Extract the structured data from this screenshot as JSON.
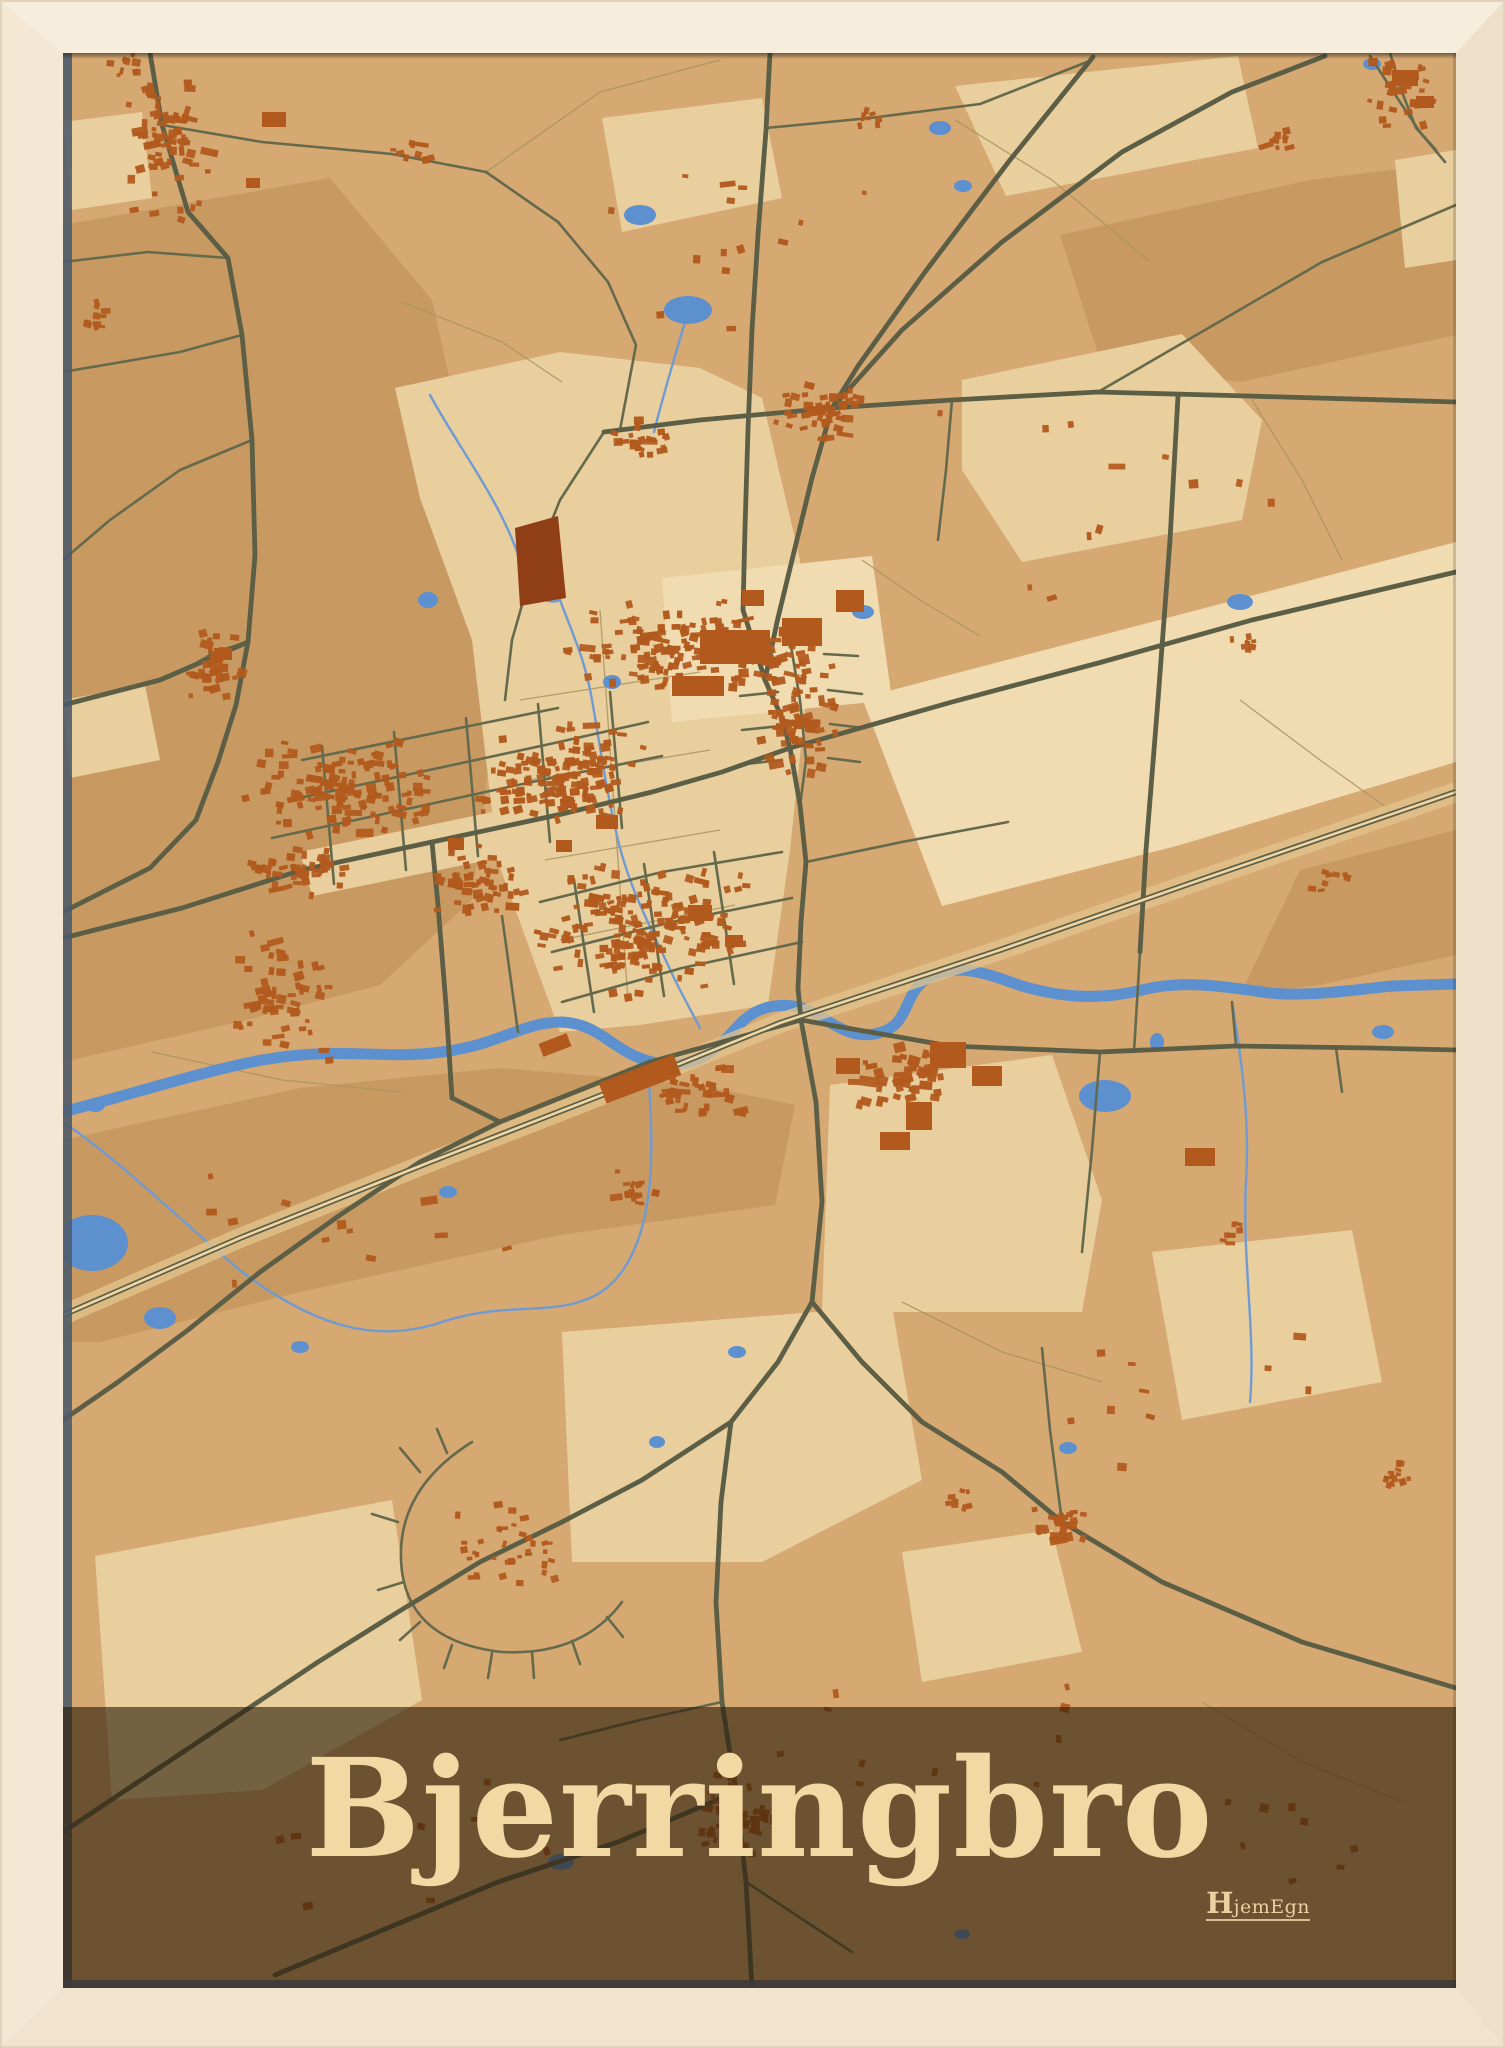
{
  "poster": {
    "title": "Bjerringbro"
  },
  "logo": {
    "h": "H",
    "rest": "jemEgn"
  },
  "colors": {
    "frame": "#f4e8d5",
    "map_base": "#d6a872",
    "patch_light": "#e9cf9e",
    "patch_xlight": "#f1dcb2",
    "patch_dark": "#c89a62",
    "road_main": "#5c5f45",
    "road_minor": "#666a4d",
    "path_thin": "#a8945f",
    "railway_band": "#e3c48e",
    "railway_line": "#5c5f45",
    "railway_center": "#efd6a6",
    "water": "#5d90cf",
    "stream": "#6f9bd2",
    "building": "#b25a1e",
    "building_dark": "#8f3e16",
    "banner_overlay": "rgba(43,29,9,0.62)",
    "title_color": "#f2d8a2",
    "logo_color": "#e9d2a2",
    "shadow_slate": "#4c5a6b"
  },
  "map": {
    "viewBox": "63 53 1393 1935",
    "patches": [
      {
        "c": "dark",
        "d": "M63,225 L330,178 L432,300 L470,470 L498,690 L472,900 L380,985 L238,1022 L63,1062 Z"
      },
      {
        "c": "dark",
        "d": "M1060,235 L1310,180 L1456,162 L1456,335 L1240,382 L1100,360 Z"
      },
      {
        "c": "dark",
        "d": "M63,1140 L300,1088 L500,1068 L700,1085 L795,1105 L775,1205 L560,1235 L300,1292 L100,1342 L63,1342 Z"
      },
      {
        "c": "dark",
        "d": "M1300,870 L1456,830 L1456,955 L1320,985 L1240,995 Z"
      },
      {
        "c": "light",
        "d": "M395,388 L560,352 L700,368 L762,398 L800,560 L806,700 L790,850 L768,1005 L640,1025 L560,1032 L498,862 L472,640 L420,498 Z"
      },
      {
        "c": "light",
        "d": "M955,86 L1238,56 L1258,148 L1006,196 Z"
      },
      {
        "c": "light",
        "d": "M962,380 L1182,334 L1262,420 L1242,520 L1022,562 L962,470 Z"
      },
      {
        "c": "xlight",
        "d": "M862,698 L1456,542 L1456,762 L1180,845 L942,906 Z"
      },
      {
        "c": "light",
        "d": "M830,1085 L1052,1055 L1102,1200 L1082,1312 L822,1312 Z"
      },
      {
        "c": "light",
        "d": "M95,1556 L392,1500 L422,1700 L262,1790 L112,1800 Z"
      },
      {
        "c": "light",
        "d": "M562,1332 L892,1306 L922,1480 L762,1562 L572,1562 Z"
      },
      {
        "c": "light",
        "d": "M602,118 L762,98 L782,198 L622,232 Z"
      },
      {
        "c": "xlight",
        "d": "M662,578 L872,556 L892,700 L672,722 Z"
      },
      {
        "c": "light",
        "d": "M300,852 L560,798 L722,752 L762,790 L562,845 L312,896 Z"
      },
      {
        "c": "light",
        "d": "M1152,1252 L1352,1230 L1382,1382 L1182,1420 Z"
      },
      {
        "c": "light",
        "d": "M63,122 L142,112 L152,198 L72,210 Z"
      },
      {
        "c": "light",
        "d": "M1395,160 L1456,150 L1456,260 L1405,268 Z"
      },
      {
        "c": "light",
        "d": "M902,1552 L1052,1530 L1082,1652 L922,1682 Z"
      },
      {
        "c": "light",
        "d": "M63,700 L145,685 L160,760 L70,778 Z"
      }
    ],
    "paths_thin": [
      "M486,172 L600,92 L720,60",
      "M955,120 L1052,180 L1150,262",
      "M1252,400 L1302,480 L1342,560",
      "M520,700 L700,672",
      "M530,780 L710,750",
      "M545,860 L720,830",
      "M560,940 L735,905",
      "M600,610 L628,1000",
      "M152,1052 L282,1080 L402,1092",
      "M902,1302 L1002,1352 L1102,1382",
      "M1202,1702 L1302,1762 L1402,1802",
      "M402,302 L502,342 L562,382",
      "M862,560 L920,600 L980,636",
      "M1240,700 L1320,760 L1390,810"
    ],
    "streams": [
      "M560,600 C575,640 585,660 592,700 C600,745 606,790 618,840 C630,890 652,930 668,965 C680,992 692,1012 700,1028",
      "M63,1122 C122,1162 182,1222 242,1272 C322,1332 382,1342 442,1322 C502,1302 545,1315 585,1300 C625,1286 645,1240 650,1180 C653,1140 650,1100 648,1064",
      "M1232,1002 C1242,1062 1250,1122 1246,1182 C1242,1262 1256,1332 1250,1402",
      "M688,312 C676,352 664,392 654,432",
      "M430,395 C460,450 500,500 520,560 C535,600 548,605 560,600"
    ],
    "river": "M63,1112 C140,1092 200,1072 262,1060 C342,1046 382,1060 442,1052 C502,1044 522,1022 562,1022 C602,1024 612,1052 652,1062 C702,1074 722,1042 742,1022 C762,1002 792,1002 812,1012 C832,1022 852,1042 882,1032 C912,1022 902,990 932,976 C962,962 992,976 1022,986 C1062,998 1102,1000 1142,990 C1182,980 1222,986 1262,992 C1302,998 1352,990 1392,986 L1456,984",
    "railway": "M63,1315 L240,1238 L430,1162 L620,1088 L780,1023 L1000,950 L1200,880 L1456,792",
    "lakes": [
      [
        92,
        1243,
        36,
        28
      ],
      [
        160,
        1318,
        16,
        11
      ],
      [
        640,
        215,
        16,
        10
      ],
      [
        688,
        310,
        24,
        14
      ],
      [
        940,
        128,
        11,
        7
      ],
      [
        963,
        186,
        9,
        6
      ],
      [
        428,
        600,
        10,
        8
      ],
      [
        612,
        682,
        9,
        7
      ],
      [
        863,
        612,
        11,
        7
      ],
      [
        1240,
        602,
        13,
        8
      ],
      [
        1105,
        1096,
        26,
        16
      ],
      [
        1383,
        1032,
        11,
        7
      ],
      [
        300,
        1347,
        9,
        6
      ],
      [
        448,
        1192,
        9,
        6
      ],
      [
        657,
        1442,
        8,
        6
      ],
      [
        1068,
        1448,
        9,
        6
      ],
      [
        561,
        1862,
        13,
        8
      ],
      [
        962,
        1934,
        8,
        5
      ],
      [
        737,
        1352,
        9,
        6
      ],
      [
        95,
        1105,
        10,
        7
      ],
      [
        1372,
        64,
        9,
        6
      ],
      [
        1157,
        1042,
        7,
        9
      ]
    ],
    "roads_minor": [
      "M162,125 L262,142 L392,154 L486,172",
      "M1456,205 L1322,262 L1205,330 L1098,392",
      "M604,432 L560,500 L532,570 L512,640 L505,700",
      "M486,172 L558,222 L608,282 L636,345 L620,430",
      "M790,640 L800,700 L806,760 L800,806",
      "M776,658 L742,660",
      "M778,692 L740,696",
      "M780,726 L742,730",
      "M782,760 L746,764",
      "M824,654 L858,656",
      "M828,690 L862,694",
      "M830,724 L864,728",
      "M828,758 L860,762",
      "M290,800 L420,772 L550,744 L648,722",
      "M272,838 L402,810 L532,782 L662,756",
      "M302,760 L430,734 L558,708",
      "M322,746 L334,884",
      "M394,732 L406,870",
      "M466,718 L478,856",
      "M538,704 L550,842",
      "M610,692 L622,828",
      "M540,902 L662,872 L782,852",
      "M552,952 L672,922 L792,898",
      "M562,1002 L682,968 L802,942",
      "M574,880 L594,1012",
      "M644,864 L664,996",
      "M714,852 L734,984",
      "M502,916 L518,1032",
      "M806,862 L902,842 L1008,822",
      "M1236,1046 L1232,1002",
      "M1336,1048 L1342,1092",
      "M1100,1052 L1092,1150 L1082,1252",
      "M472,1442 Q392,1492 402,1572 Q412,1642 502,1652 Q582,1656 622,1602",
      "M420,1472 L400,1448",
      "M398,1522 L372,1514",
      "M404,1582 L378,1590",
      "M420,1622 L400,1640",
      "M452,1645 L444,1668",
      "M492,1653 L488,1678",
      "M532,1652 L534,1678",
      "M572,1641 L580,1664",
      "M607,1617 L623,1637",
      "M447,1453 L437,1429",
      "M63,262 L148,252 L228,258",
      "M242,335 L180,352 L63,372",
      "M252,440 L180,470 L110,520 L63,560",
      "M1140,952 L1134,1052",
      "M1062,1522 L1050,1430 L1042,1348",
      "M746,1882 L852,1952",
      "M1370,56 L1396,96 L1420,132 L1445,162",
      "M766,128 L870,118 L980,104 L1092,60",
      "M952,400 L946,470 L938,540",
      "M248,642 L215,652 L188,668",
      "M1390,53 L1402,92 L1416,128 L1436,150",
      "M722,1702 L640,1720 L560,1740"
    ],
    "roads_main": [
      "M150,53 L162,125 L188,212 L228,258 L242,335 L252,440 L255,555 L248,642",
      "M248,642 L236,705 L218,762 L196,820 L150,868 L63,912",
      "M248,642 L160,680 L63,705",
      "M770,53 L766,130 L758,235 L752,330 L748,430 L745,528 L743,610 L765,680 L782,718 L790,748",
      "M1093,57 L1010,160 L925,272 L858,366 L832,408",
      "M832,408 L812,478 L793,556 L777,622 L765,680",
      "M604,432 L700,420 L832,408 L952,400 L1098,392 L1248,396 L1456,402",
      "M832,408 L902,330 L1002,242 L1122,152 L1232,92 L1325,56",
      "M63,938 L182,908 L302,870 L432,842 L562,814 L652,792 L722,772 L790,748",
      "M790,748 L952,702 L1102,662 L1252,620 L1456,572",
      "M790,748 L800,805 L806,862 L801,922 L798,988 L801,1020",
      "M801,1020 L816,1102 L822,1202 L812,1302",
      "M801,1020 L950,1046 L1100,1052 L1236,1046 L1372,1048 L1456,1050",
      "M500,1122 L650,1062 L801,1020",
      "M812,1302 L778,1362 L731,1422 L642,1480 L562,1522",
      "M812,1302 L862,1362 L922,1422 L1002,1472 L1062,1522 L1162,1582 L1302,1642 L1456,1688",
      "M731,1422 L721,1502 L716,1602 L722,1702 L736,1792 L746,1882 L752,1988",
      "M562,1522 L480,1562 L398,1612 L318,1662 L228,1722 L138,1782 L63,1832",
      "M736,1792 L618,1842 L498,1882 L378,1932 L275,1975",
      "M432,842 L438,905 L446,1005 L452,1098 L500,1122",
      "M500,1122 L420,1162 L340,1215 L260,1272 L188,1330 L118,1382 L63,1420",
      "M1178,396 L1170,540 L1158,700 L1146,850 L1140,952"
    ],
    "wedge": "M515,528 L558,516 L566,598 L520,606 Z",
    "big_buildings": [
      [
        700,
        630,
        70,
        34,
        0
      ],
      [
        782,
        618,
        40,
        28,
        0
      ],
      [
        672,
        676,
        52,
        20,
        0
      ],
      [
        836,
        590,
        28,
        22,
        0
      ],
      [
        742,
        590,
        22,
        16,
        0
      ],
      [
        600,
        1068,
        80,
        22,
        -21
      ],
      [
        540,
        1038,
        30,
        14,
        -21
      ],
      [
        930,
        1042,
        36,
        26,
        0
      ],
      [
        972,
        1066,
        30,
        20,
        0
      ],
      [
        906,
        1102,
        26,
        28,
        0
      ],
      [
        880,
        1132,
        30,
        18,
        0
      ],
      [
        836,
        1058,
        24,
        16,
        0
      ],
      [
        1185,
        1148,
        30,
        18,
        0
      ],
      [
        262,
        112,
        24,
        15,
        0
      ],
      [
        246,
        178,
        14,
        10,
        0
      ],
      [
        1392,
        70,
        26,
        16,
        0
      ],
      [
        1416,
        96,
        18,
        12,
        0
      ],
      [
        596,
        815,
        22,
        14,
        0
      ],
      [
        556,
        840,
        16,
        12,
        0
      ],
      [
        214,
        648,
        18,
        12,
        0
      ],
      [
        688,
        905,
        24,
        16,
        0
      ],
      [
        725,
        935,
        18,
        12,
        0
      ],
      [
        448,
        838,
        16,
        12,
        0
      ]
    ],
    "clusters": [
      [
        168,
        145,
        50,
        95,
        65,
        6
      ],
      [
        128,
        62,
        26,
        16,
        10,
        5
      ],
      [
        822,
        408,
        52,
        36,
        46,
        6
      ],
      [
        1402,
        92,
        36,
        40,
        30,
        6
      ],
      [
        1278,
        142,
        22,
        16,
        9,
        5
      ],
      [
        215,
        662,
        30,
        40,
        34,
        6
      ],
      [
        285,
        1000,
        55,
        75,
        55,
        6
      ],
      [
        340,
        790,
        100,
        50,
        120,
        6
      ],
      [
        560,
        775,
        95,
        55,
        140,
        6
      ],
      [
        660,
        650,
        95,
        50,
        110,
        6
      ],
      [
        800,
        722,
        45,
        70,
        70,
        6
      ],
      [
        640,
        930,
        110,
        70,
        170,
        6
      ],
      [
        480,
        880,
        55,
        38,
        55,
        6
      ],
      [
        740,
        1815,
        48,
        42,
        50,
        6
      ],
      [
        1062,
        1525,
        28,
        24,
        26,
        6
      ],
      [
        1395,
        1478,
        20,
        16,
        13,
        5
      ],
      [
        500,
        1545,
        75,
        45,
        35,
        5
      ],
      [
        700,
        1090,
        45,
        28,
        35,
        6
      ],
      [
        905,
        1075,
        55,
        38,
        40,
        7
      ],
      [
        760,
        658,
        65,
        35,
        40,
        7
      ],
      [
        420,
        148,
        28,
        13,
        9,
        5
      ],
      [
        95,
        312,
        16,
        22,
        10,
        5
      ],
      [
        640,
        440,
        40,
        22,
        22,
        6
      ],
      [
        1230,
        1235,
        16,
        12,
        7,
        5
      ],
      [
        870,
        118,
        18,
        11,
        8,
        5
      ],
      [
        300,
        870,
        55,
        28,
        45,
        6
      ],
      [
        1330,
        880,
        20,
        14,
        8,
        5
      ],
      [
        1240,
        640,
        16,
        12,
        7,
        5
      ],
      [
        630,
        1190,
        30,
        20,
        15,
        5
      ],
      [
        960,
        1500,
        20,
        14,
        8,
        5
      ],
      [
        700,
        240,
        250,
        120,
        14,
        6
      ],
      [
        1100,
        500,
        200,
        120,
        12,
        6
      ],
      [
        350,
        1250,
        200,
        80,
        12,
        6
      ],
      [
        1150,
        1400,
        180,
        120,
        10,
        6
      ],
      [
        900,
        1750,
        250,
        100,
        12,
        6
      ],
      [
        400,
        1850,
        250,
        80,
        10,
        6
      ],
      [
        1300,
        1850,
        140,
        90,
        8,
        6
      ]
    ]
  }
}
